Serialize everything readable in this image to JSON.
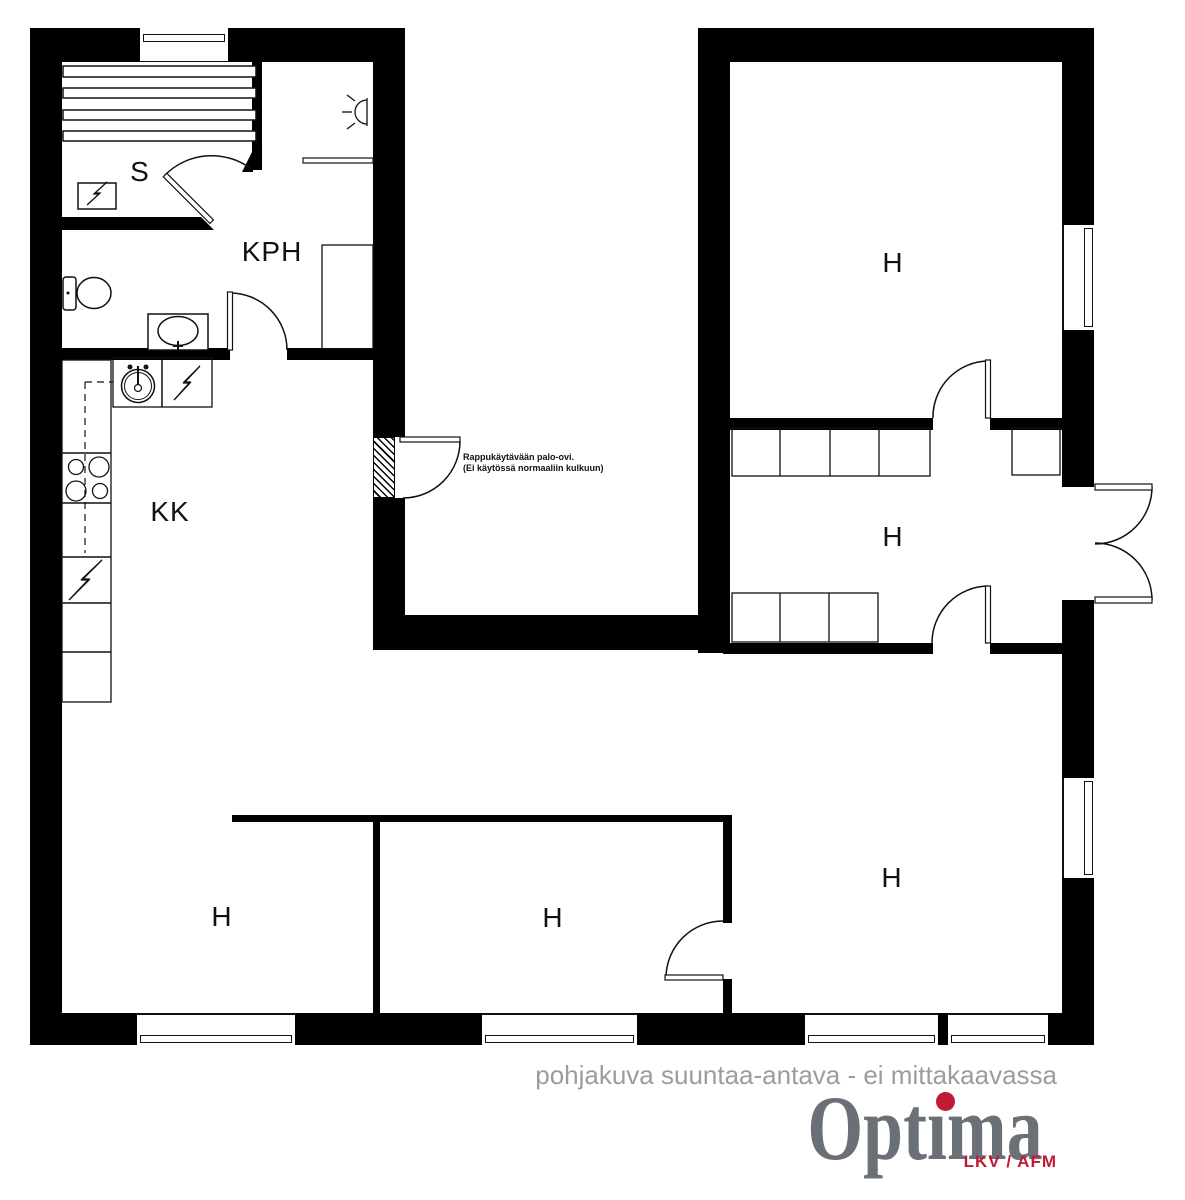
{
  "plan": {
    "rooms": [
      {
        "id": "sauna",
        "label": "S"
      },
      {
        "id": "bathroom",
        "label": "KPH"
      },
      {
        "id": "kitchenette",
        "label": "KK"
      },
      {
        "id": "room-top-right",
        "label": "H"
      },
      {
        "id": "hall",
        "label": "H"
      },
      {
        "id": "room-bottom-left",
        "label": "H"
      },
      {
        "id": "room-bottom-middle",
        "label": "H"
      },
      {
        "id": "room-bottom-right",
        "label": "H"
      }
    ],
    "note": {
      "line1": "Rappukäytävään palo-ovi.",
      "line2": "(Ei käytössä normaaliin kulkuun)"
    }
  },
  "footer": {
    "disclaimer": "pohjakuva suuntaa-antava - ei mittakaavassa",
    "logo": {
      "pre": "Opt",
      "i": "ı",
      "post": "ma",
      "full": "Optima",
      "sub": "LKV / AFM"
    }
  },
  "colors": {
    "wall": "#000000",
    "lines": "#111111",
    "disclaimer_gray": "#9c9c9c",
    "logo_gray": "#6b7077",
    "logo_red": "#bf1b36"
  }
}
